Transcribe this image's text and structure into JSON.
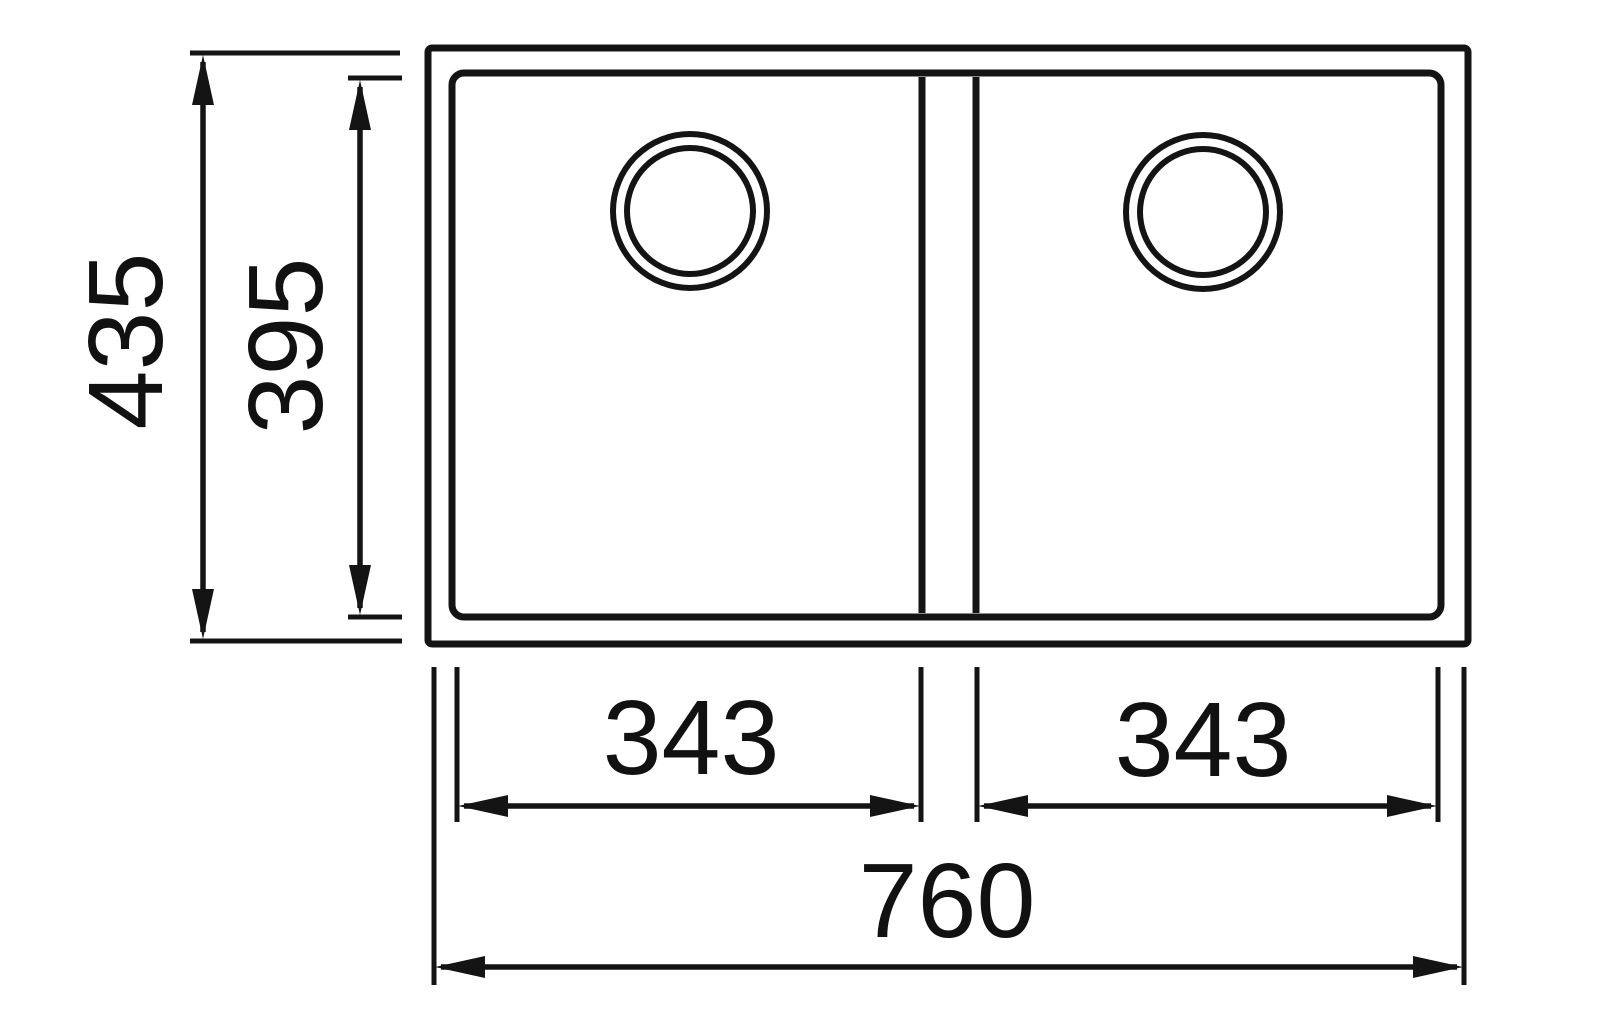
{
  "diagram": {
    "title": "double-bowl-undermount-sink-dimension-drawing",
    "units_shown": false,
    "colors": {
      "line": "#141414",
      "text": "#111111",
      "background": "#ffffff"
    },
    "dimensions": {
      "overall_height": {
        "label": "435",
        "orientation": "vertical"
      },
      "bowl_depth": {
        "label": "395",
        "orientation": "vertical"
      },
      "left_bowl_width": {
        "label": "343",
        "orientation": "horizontal"
      },
      "right_bowl_width": {
        "label": "343",
        "orientation": "horizontal"
      },
      "overall_width": {
        "label": "760",
        "orientation": "horizontal"
      }
    },
    "features": {
      "bowl_count": 2,
      "drains_per_bowl": 1
    }
  }
}
